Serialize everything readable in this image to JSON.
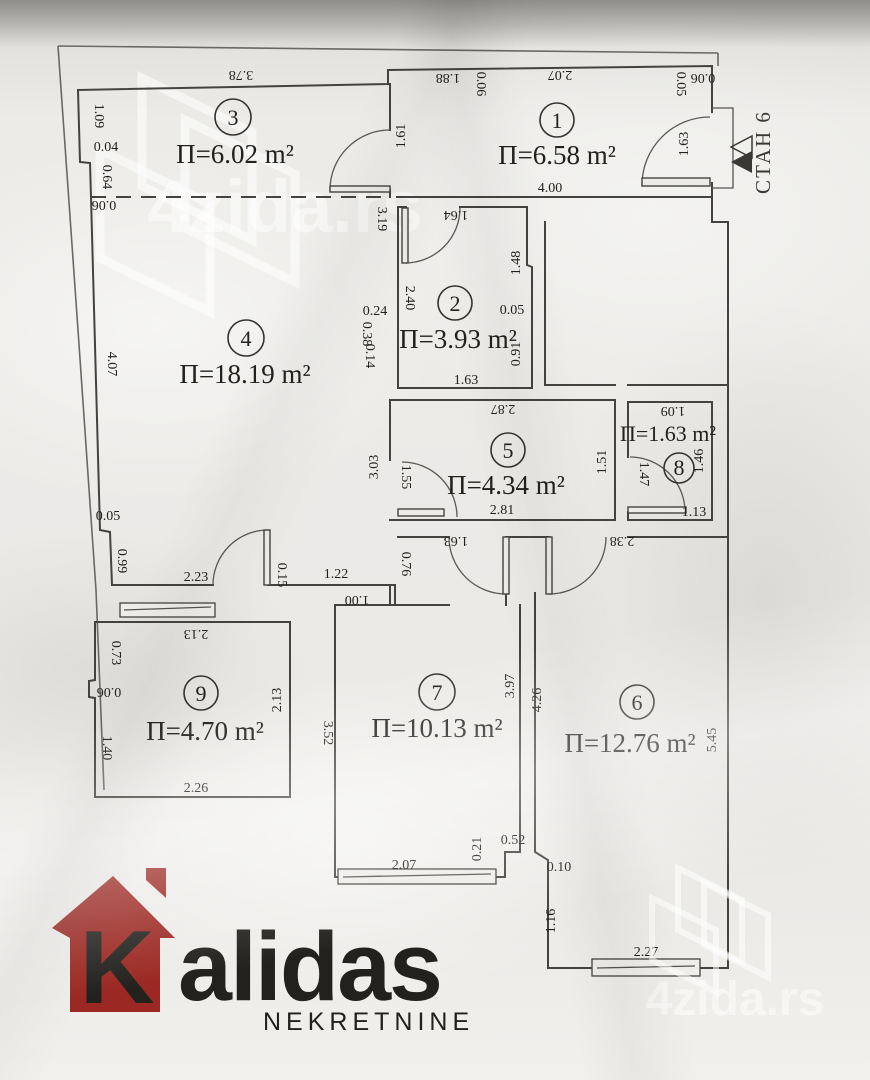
{
  "plan": {
    "apartment_label": "СТАН 6",
    "rooms": [
      {
        "num": "3",
        "area": "П=6.02 m²"
      },
      {
        "num": "1",
        "area": "П=6.58 m²"
      },
      {
        "num": "2",
        "area": "П=3.93 m²"
      },
      {
        "num": "4",
        "area": "П=18.19 m²"
      },
      {
        "num": "5",
        "area": "П=4.34 m²"
      },
      {
        "num": "8",
        "area": "П=1.63 m²"
      },
      {
        "num": "9",
        "area": "П=4.70 m²"
      },
      {
        "num": "7",
        "area": "П=10.13 m²"
      },
      {
        "num": "6",
        "area": "П=12.76 m²"
      }
    ],
    "dims": [
      "3.78",
      "1.09",
      "0.04",
      "0.64",
      "0.06",
      "1.88",
      "0.06",
      "2.07",
      "0.05",
      "0.06",
      "1.61",
      "1.63",
      "4.00",
      "1.64",
      "3.19",
      "2.40",
      "1.48",
      "0.05",
      "0.91",
      "1.63",
      "0.24",
      "0.38",
      "0.14",
      "4.07",
      "2.87",
      "1.55",
      "3.03",
      "1.51",
      "2.81",
      "1.09",
      "1.47",
      "1.46",
      "1.13",
      "2.38",
      "1.63",
      "0.76",
      "0.05",
      "0.99",
      "2.23",
      "0.15",
      "1.22",
      "1.00",
      "2.13",
      "0.73",
      "0.06",
      "1.40",
      "2.26",
      "2.13",
      "3.52",
      "3.97",
      "4.26",
      "5.45",
      "2.07",
      "0.21",
      "0.52",
      "0.10",
      "1.16",
      "2.27"
    ]
  },
  "logo": {
    "k": "K",
    "name": "alidas",
    "subtitle": "NEKRETNINE",
    "house_color": "#9b2822"
  },
  "watermark": {
    "text": "4zida.rs"
  }
}
